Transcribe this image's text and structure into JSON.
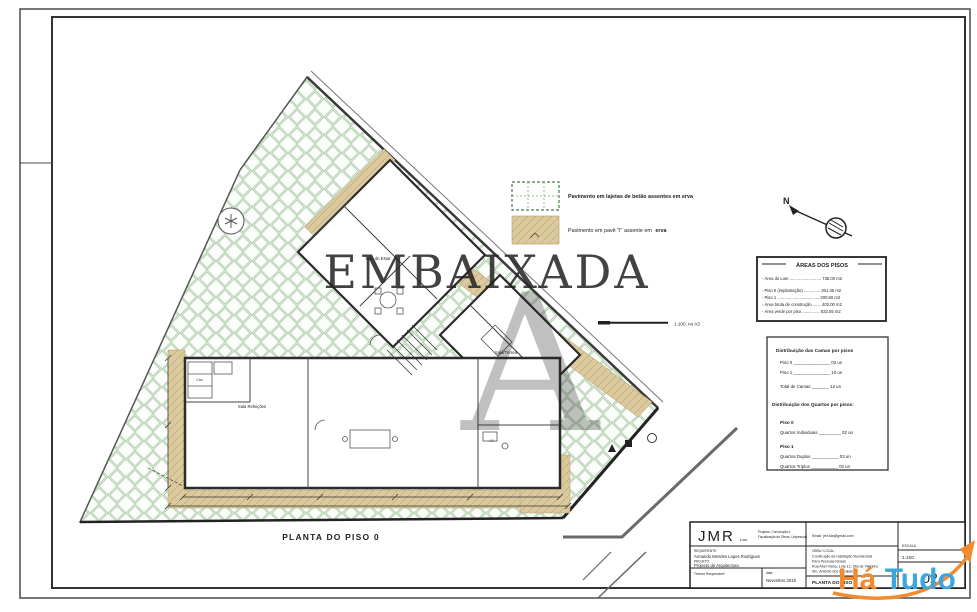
{
  "sheet": {
    "caption": "PLANTA DO PISO 0"
  },
  "watermark": {
    "name": "EMBAIXADA",
    "monogram": "A",
    "color": "#8f8f8f"
  },
  "hatudo": {
    "part1": "Há",
    "part2": "Tudo",
    "orange": "#f28a2e",
    "blue": "#3ba7de"
  },
  "legend": {
    "item1": "Pavimento em lajetas de betão assentes em erva",
    "item2": "Pavimento em pavê \"I\" assente em",
    "item2_bold": "erva"
  },
  "north_label": "N",
  "scalebar": {
    "label": "1:100, no A3"
  },
  "areas": {
    "title": "ÁREAS DOS PISOS",
    "rows": [
      "- Área do Lote ........................... 735.00 m2",
      "- Piso 0 (implantação) .............. 201.45 m2",
      "- Piso 1 .................................... 200.50 m2",
      "- Área bruta de construção ....... 402.00 m2",
      "- Área verde por piso ............... 533.55 m2"
    ]
  },
  "camas": {
    "title": "Distribuição das Camas por pisos",
    "rows": [
      "Piso 0 _______________ 02 un",
      "Piso 1 _______________ 10 un",
      "Total de Camas _______ 12 un"
    ]
  },
  "quartos": {
    "title": "Distribuição dos Quartos por pisos:",
    "piso0_label": "Piso 0",
    "piso0_row": "Quartos Individuais _________ 02 un",
    "piso1_label": "Piso 1",
    "piso1_row1": "Quartos Duplos ___________ 03 un",
    "piso1_row2": "Quartos Triplos ___________ 02 un"
  },
  "plan": {
    "rooms": [
      "Sala Refeições",
      "Sala de Estar",
      "Sala/Térrea",
      "Coz.",
      "I.S."
    ]
  },
  "titleblock": {
    "company": "JMR",
    "company_suffix": "Lda.",
    "desc_line1": "Projetos, Construção e",
    "desc_line2": "Fiscalização de Obras, Unipessoal",
    "email": "Email: jmr.lda@gmail.com",
    "requerente_label": "REQUERENTE:",
    "requerente": "Armando Mendes Lopes Rodrigues",
    "projeto_label": "PROJETO:",
    "projeto": "Projecto de Arquitectura",
    "tecnico_label": "Técnico Responsável",
    "data_label": "data:",
    "data_value": "Novembro 2019",
    "obra_label": "OBRA / LOCAL:",
    "obra_line1": "Construção de Habitação Residencial",
    "obra_line2": "Para Pessoas Idosas",
    "obra_line3": "Rua Abel Viana, Lote 12, Qta de Vilarinho",
    "obra_line4": "Sto. António dos Cavaleiros",
    "drawing_title": "PLANTA DO PISO 0",
    "escala_label": "ESCALA",
    "escala_value": "1:100",
    "sheet_number": "02"
  },
  "colors": {
    "grass_line": "#b7d2b4",
    "pave_fill": "#dbca9e"
  }
}
